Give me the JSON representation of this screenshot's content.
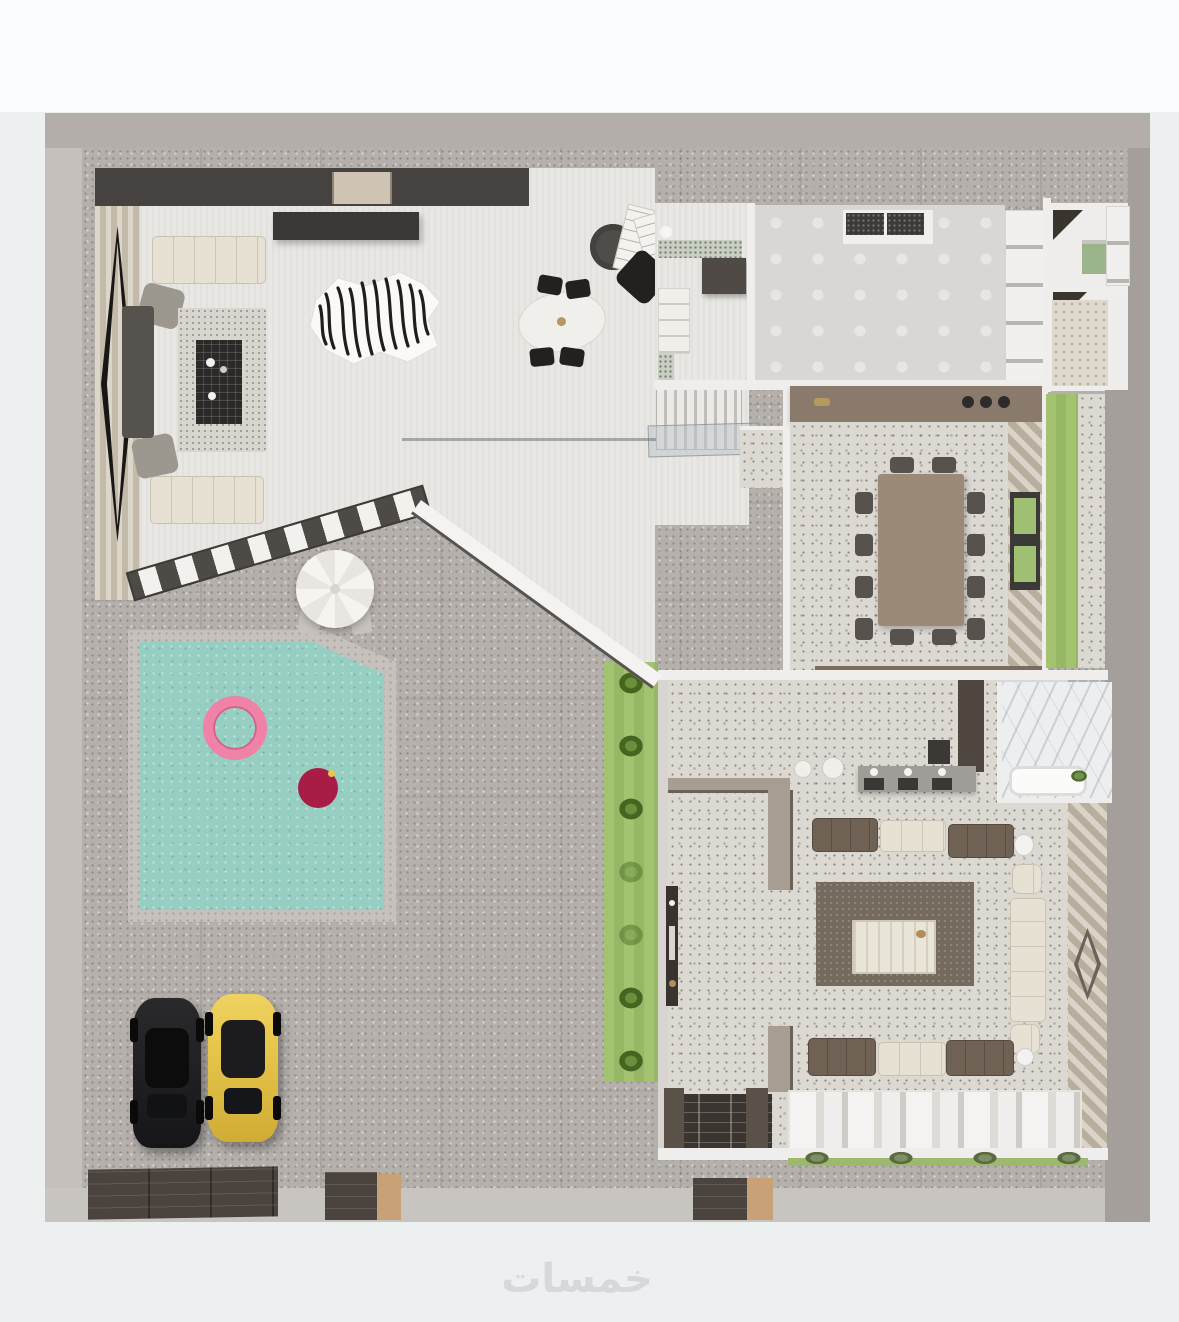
{
  "watermark": {
    "text": "خمسات"
  },
  "palette": {
    "page_bg": "#edf0f1",
    "page_top": "#fbfcfd",
    "wall_top": "#b4aeaa",
    "wall_left": "#c5c0bc",
    "wall_right": "#a59f9b",
    "wall_bottom": "#c8c4c0",
    "wall_interior": "#f0eeec",
    "paving": "#b5b0ac",
    "terrazzo": "#dcd8d2",
    "white_floor": "#e9e7e4",
    "bedroom_floor": "#d9d6d3",
    "charcoal": "#46423f",
    "wood": "#cfc7b8",
    "lawn": "#a3c371",
    "lawn_dark": "#95b766",
    "bush": "#46661f",
    "pool_water": "#96cfc2",
    "pool_rim": "#c6c1bc",
    "umbrella": "#f3f1ed",
    "float_pink": "#ef82a6",
    "float_red": "#a81d46",
    "sofa_cream": "#e7e1d4",
    "sofa_brown": "#6f6255",
    "chair_gray": "#9c978f",
    "chair_dark": "#57524d",
    "table_brown": "#9c8a79",
    "counter_brown": "#8a7a6b",
    "rug_dark": "#746b5e",
    "rug_light": "#d8d5cf",
    "marble": "#eceef0",
    "glass": "#b9c3c7",
    "car_black": "#1d1d1f",
    "car_yellow": "#e6c44a",
    "door_dark": "#4a433e",
    "door_tan": "#c8a176",
    "watermark_color": "#d6d9db"
  },
  "scene": {
    "counts": {
      "hedge_bushes": 7,
      "terrace_bushes": 4,
      "dining_side_chairs": 4,
      "dining_end_chairs": 2
    }
  }
}
